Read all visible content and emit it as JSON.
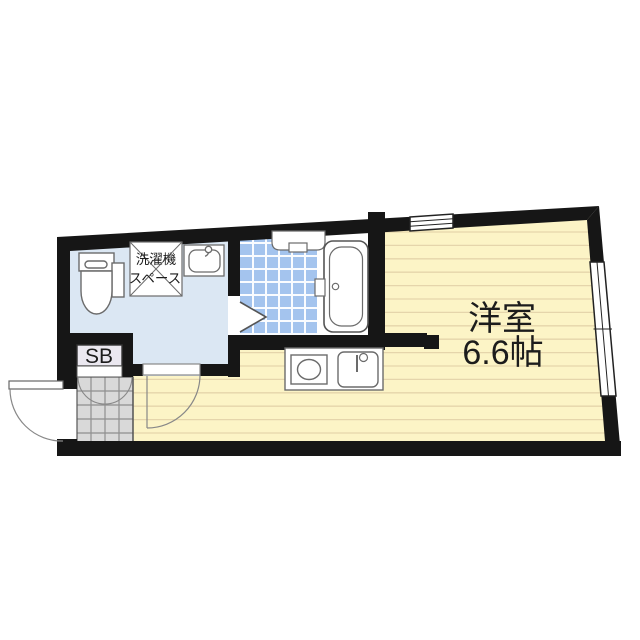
{
  "plan": {
    "type": "apartment-floor-plan",
    "rooms": {
      "main_room": {
        "label": "洋室",
        "size": "6.6帖"
      },
      "washer_space": {
        "line1": "洗濯機",
        "line2": "スペース"
      },
      "shoe_box": {
        "label": "SB"
      }
    },
    "fixtures": [
      "toilet",
      "wash-basin",
      "washing-machine-space",
      "bath-shelf",
      "bathtub",
      "bath-folding-door",
      "kitchen-counter",
      "stove-burner",
      "kitchen-sink",
      "shoe-box",
      "entrance-door",
      "washroom-door",
      "shoe-box-doors",
      "top-window",
      "right-window",
      "genkan-tile-floor"
    ],
    "palette": {
      "wall": "#161616",
      "main_room_floor": "#fcf4c6",
      "main_room_lines": "#e5d5ab",
      "washroom_floor": "#dbe7f3",
      "bath_tile": "#a4c4ee",
      "bath_tile_grid": "#ffffff",
      "tub_zone": "#ffffff",
      "genkan_tile": "#d9d9d9",
      "genkan_grid": "#8f8f8f",
      "shoe_box_fill": "#ebe8f0",
      "fixture_stroke": "#6b6b6b",
      "door_stroke": "#888888",
      "text": "#1c1c1c"
    }
  }
}
